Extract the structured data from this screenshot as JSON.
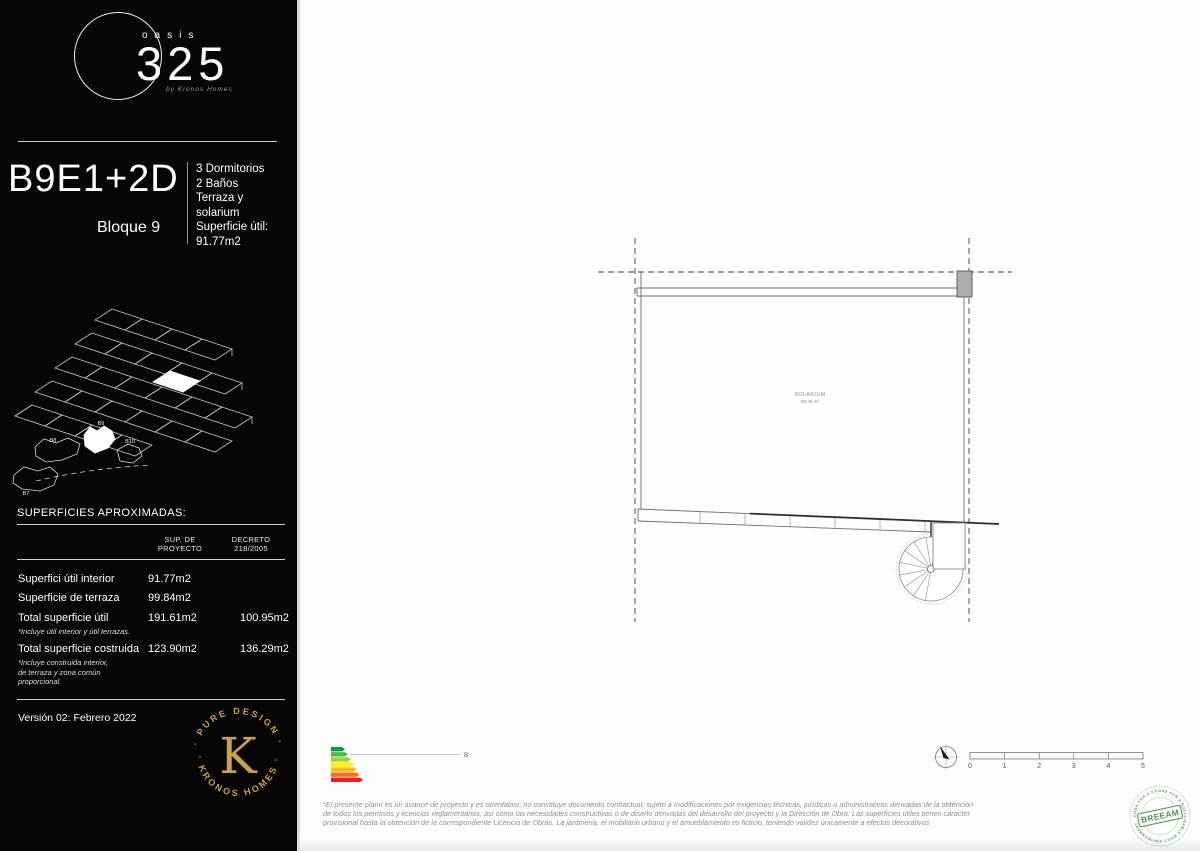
{
  "sidebar": {
    "logo": {
      "word": "oasis",
      "number": "325",
      "byline": "by Kronos Homes"
    },
    "unit_code": "B9E1+2D",
    "block": "Bloque 9",
    "features": [
      "3 Dormitorios",
      "2 Baños",
      "Terraza y",
      "solarium",
      "Superficie útil:",
      "91.77m2"
    ],
    "site_labels": {
      "b7": "B7",
      "b8": "B8",
      "b9": "B9",
      "b10": "B10"
    },
    "table": {
      "title": "SUPERFICIES APROXIMADAS:",
      "col_proyecto": "SUP. DE\nPROYECTO",
      "col_decreto": "DECRETO\n218/2005",
      "rows": [
        {
          "label": "Superfici útil interior",
          "proyecto": "91.77m2",
          "decreto": ""
        },
        {
          "label": "Superficie de terraza",
          "proyecto": "99.84m2",
          "decreto": ""
        },
        {
          "label": "Total superficie útil",
          "note": "*Incluye útil interior y útil terrazas.",
          "proyecto": "191.61m2",
          "decreto": "100.95m2"
        },
        {
          "label": "Total superficie costruida",
          "note": "*Incluye construida interior,\nde terraza y zona común\nproporcional.",
          "proyecto": "123.90m2",
          "decreto": "136.29m2"
        }
      ]
    },
    "version": "Versión 02: Febrero 2022",
    "kronos": {
      "arc_top": "· PURE DESIGN ·",
      "arc_bottom": "· KRONOS HOMES ·",
      "monogram": "K"
    }
  },
  "plan": {
    "room": {
      "label": "SOLARIUM",
      "area": "80.48 m²"
    }
  },
  "energy": {
    "rating": "B",
    "bar_colors": [
      "#009a44",
      "#4db848",
      "#a6ce39",
      "#fff200",
      "#fdb913",
      "#f36f21",
      "#ea1d25"
    ]
  },
  "scale_bar": {
    "ticks": [
      "0",
      "1",
      "2",
      "3",
      "4",
      "5"
    ]
  },
  "breeam": {
    "name": "BREEAM",
    "ring_text": "CODE FOR A SUSTAINABLE BUILT ENVIRONMENT · CODE FOR A SUSTAINABLE"
  },
  "footer": {
    "disclaimer": "*El presente plano es un avance de proyecto y es orientativo; no constituye documento contractual; sujeto a modificaciones por exigencias técnicas, jurídicas o administrativas derivadas de la obtención de todos los permisos y licencias reglamentarios, así como las necesidades constructivas o de diseño derivadas del desarrollo del proyecto y la Dirección de Obra. Las superficies útiles tienen carácter provisional hasta la obtención de la correspondiente Licencia de Obras. La jardinería, el mobiliario urbano y el amueblamiento es ficticio, teniendo validez únicamente a efectos decorativos"
  }
}
